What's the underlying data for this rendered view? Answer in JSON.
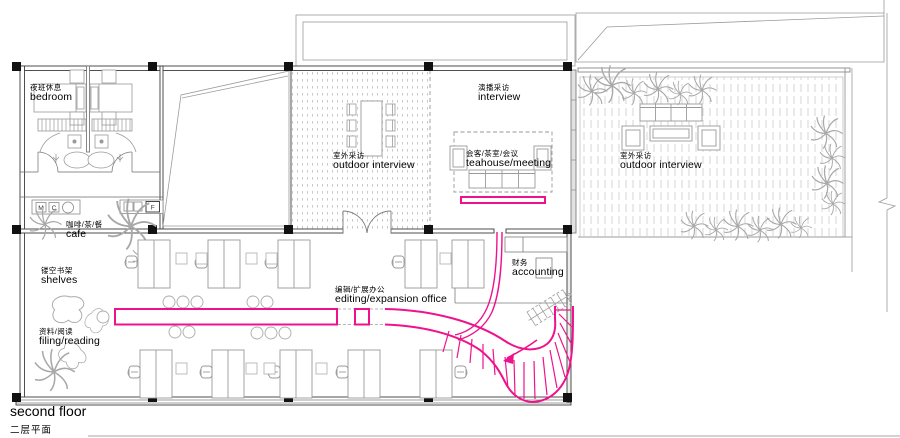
{
  "title": {
    "en": "second floor",
    "zh": "二层平面"
  },
  "rooms": {
    "bedroom": {
      "zh": "夜班休息",
      "en": "bedroom"
    },
    "cafe": {
      "zh": "咖啡/茶/餐",
      "en": "cafe"
    },
    "shelves": {
      "zh": "镂空书架",
      "en": "shelves"
    },
    "filing_reading": {
      "zh": "资料/阅读",
      "en": "filing/reading"
    },
    "outdoor_interview_west": {
      "zh": "室外采访",
      "en": "outdoor interview"
    },
    "interview": {
      "zh": "演播采访",
      "en": "interview"
    },
    "teahouse_meeting": {
      "zh": "会客/茶室/会议",
      "en": "teahouse/meeting"
    },
    "outdoor_interview_east": {
      "zh": "室外采访",
      "en": "outdoor interview"
    },
    "editing_office": {
      "zh": "编辑/扩展办公",
      "en": "editing/expansion office"
    },
    "accounting": {
      "zh": "财务",
      "en": "accounting"
    }
  },
  "equipment_tags": {
    "m": "M",
    "c": "C",
    "f": "F"
  },
  "colors": {
    "highlight": "#F0128C",
    "wall": "#3c3c3c",
    "furniture": "#9a9a9a",
    "deck": "#cccccc"
  }
}
